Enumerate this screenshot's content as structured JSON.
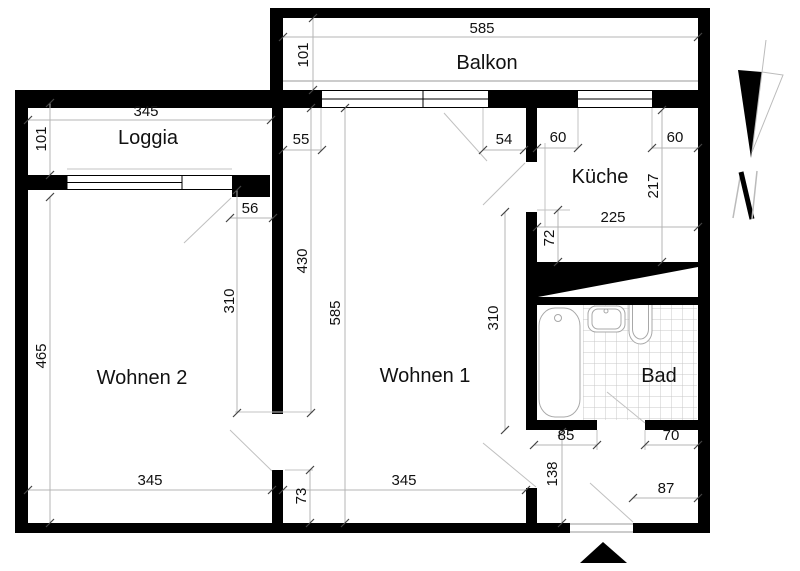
{
  "rooms": {
    "balkon": "Balkon",
    "loggia": "Loggia",
    "kueche": "Küche",
    "wohnen1": "Wohnen 1",
    "wohnen2": "Wohnen 2",
    "bad": "Bad"
  },
  "compass": {
    "label": "N"
  },
  "dims": {
    "balkon_width": "585",
    "balkon_depth": "101",
    "loggia_width": "345",
    "loggia_depth": "101",
    "pier_left": "55",
    "pier_right": "54",
    "kueche_win_left": "60",
    "kueche_win_right": "60",
    "kueche_depth": "217",
    "kueche_width": "225",
    "kueche_door": "72",
    "loggia_door": "56",
    "wohnen1_upper": "430",
    "wohnen1_depth": "585",
    "wohnen1_wall": "310",
    "wohnen2_wall": "310",
    "wohnen2_depth": "465",
    "wohnen2_width": "345",
    "wohnen1_width": "345",
    "wall_stub": "73",
    "flur_depth": "138",
    "bad_left": "85",
    "bad_right": "70",
    "entry_width": "87"
  },
  "colors": {
    "wall": "#000000",
    "dim_line": "#b4b4b4",
    "tile": "#cccccc",
    "fixture_outline": "#a8a8a8"
  }
}
